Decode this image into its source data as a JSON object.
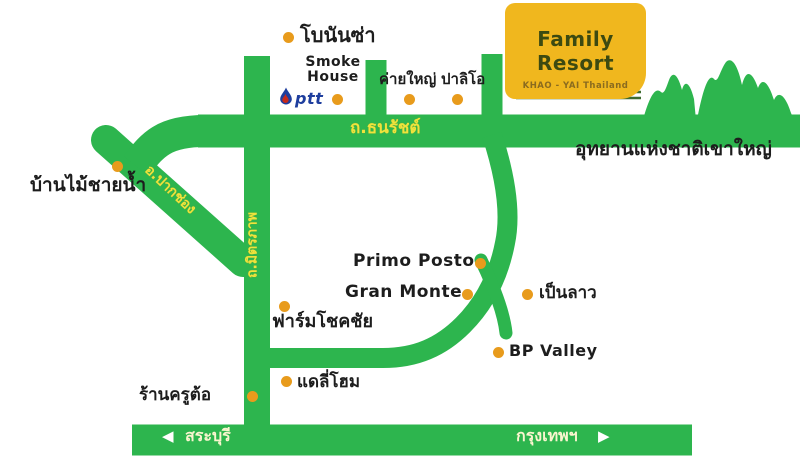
{
  "sign": {
    "title": "Family Resort",
    "subtitle": "KHAO - YAI Thailand"
  },
  "roads": {
    "thanarat": "ถ.ธนรัชต์",
    "mittraphap": "ถ.มิตรภาพ",
    "pakchong": "อ.ปากช่อง"
  },
  "directions": {
    "west": "สระบุรี",
    "east": "กรุงเทพฯ",
    "west_arrow": "◀",
    "east_arrow": "▶"
  },
  "park": "อุทยานแห่งชาติเขาใหญ่",
  "places": {
    "bonanza": "โบนันซ่า",
    "smoke_house": "Smoke\nHouse",
    "ptt": "ptt",
    "khai_yai": "ค่ายใหญ่",
    "palio": "ปาลิโอ",
    "baan_mai_chai_nam": "บ้านไม้ชายน้ำ",
    "primo_posto": "Primo Posto",
    "gran_monte": "Gran Monte",
    "pen_lao": "เป็นลาว",
    "farm_chokchai": "ฟาร์มโชคชัย",
    "bp_valley": "BP Valley",
    "ran_khru_tor": "ร้านครูต้อ",
    "dairy_home": "แดลี่โฮม"
  },
  "colors": {
    "road_green": "#2DB54E",
    "driveway_dark_green": "#3E6B2F",
    "marker_orange": "#E89B1C",
    "sign_yellow": "#F0B71E",
    "road_label_yellow": "#EFE33C",
    "ptt_blue": "#1E3E9E",
    "ptt_red": "#C62A1C"
  }
}
